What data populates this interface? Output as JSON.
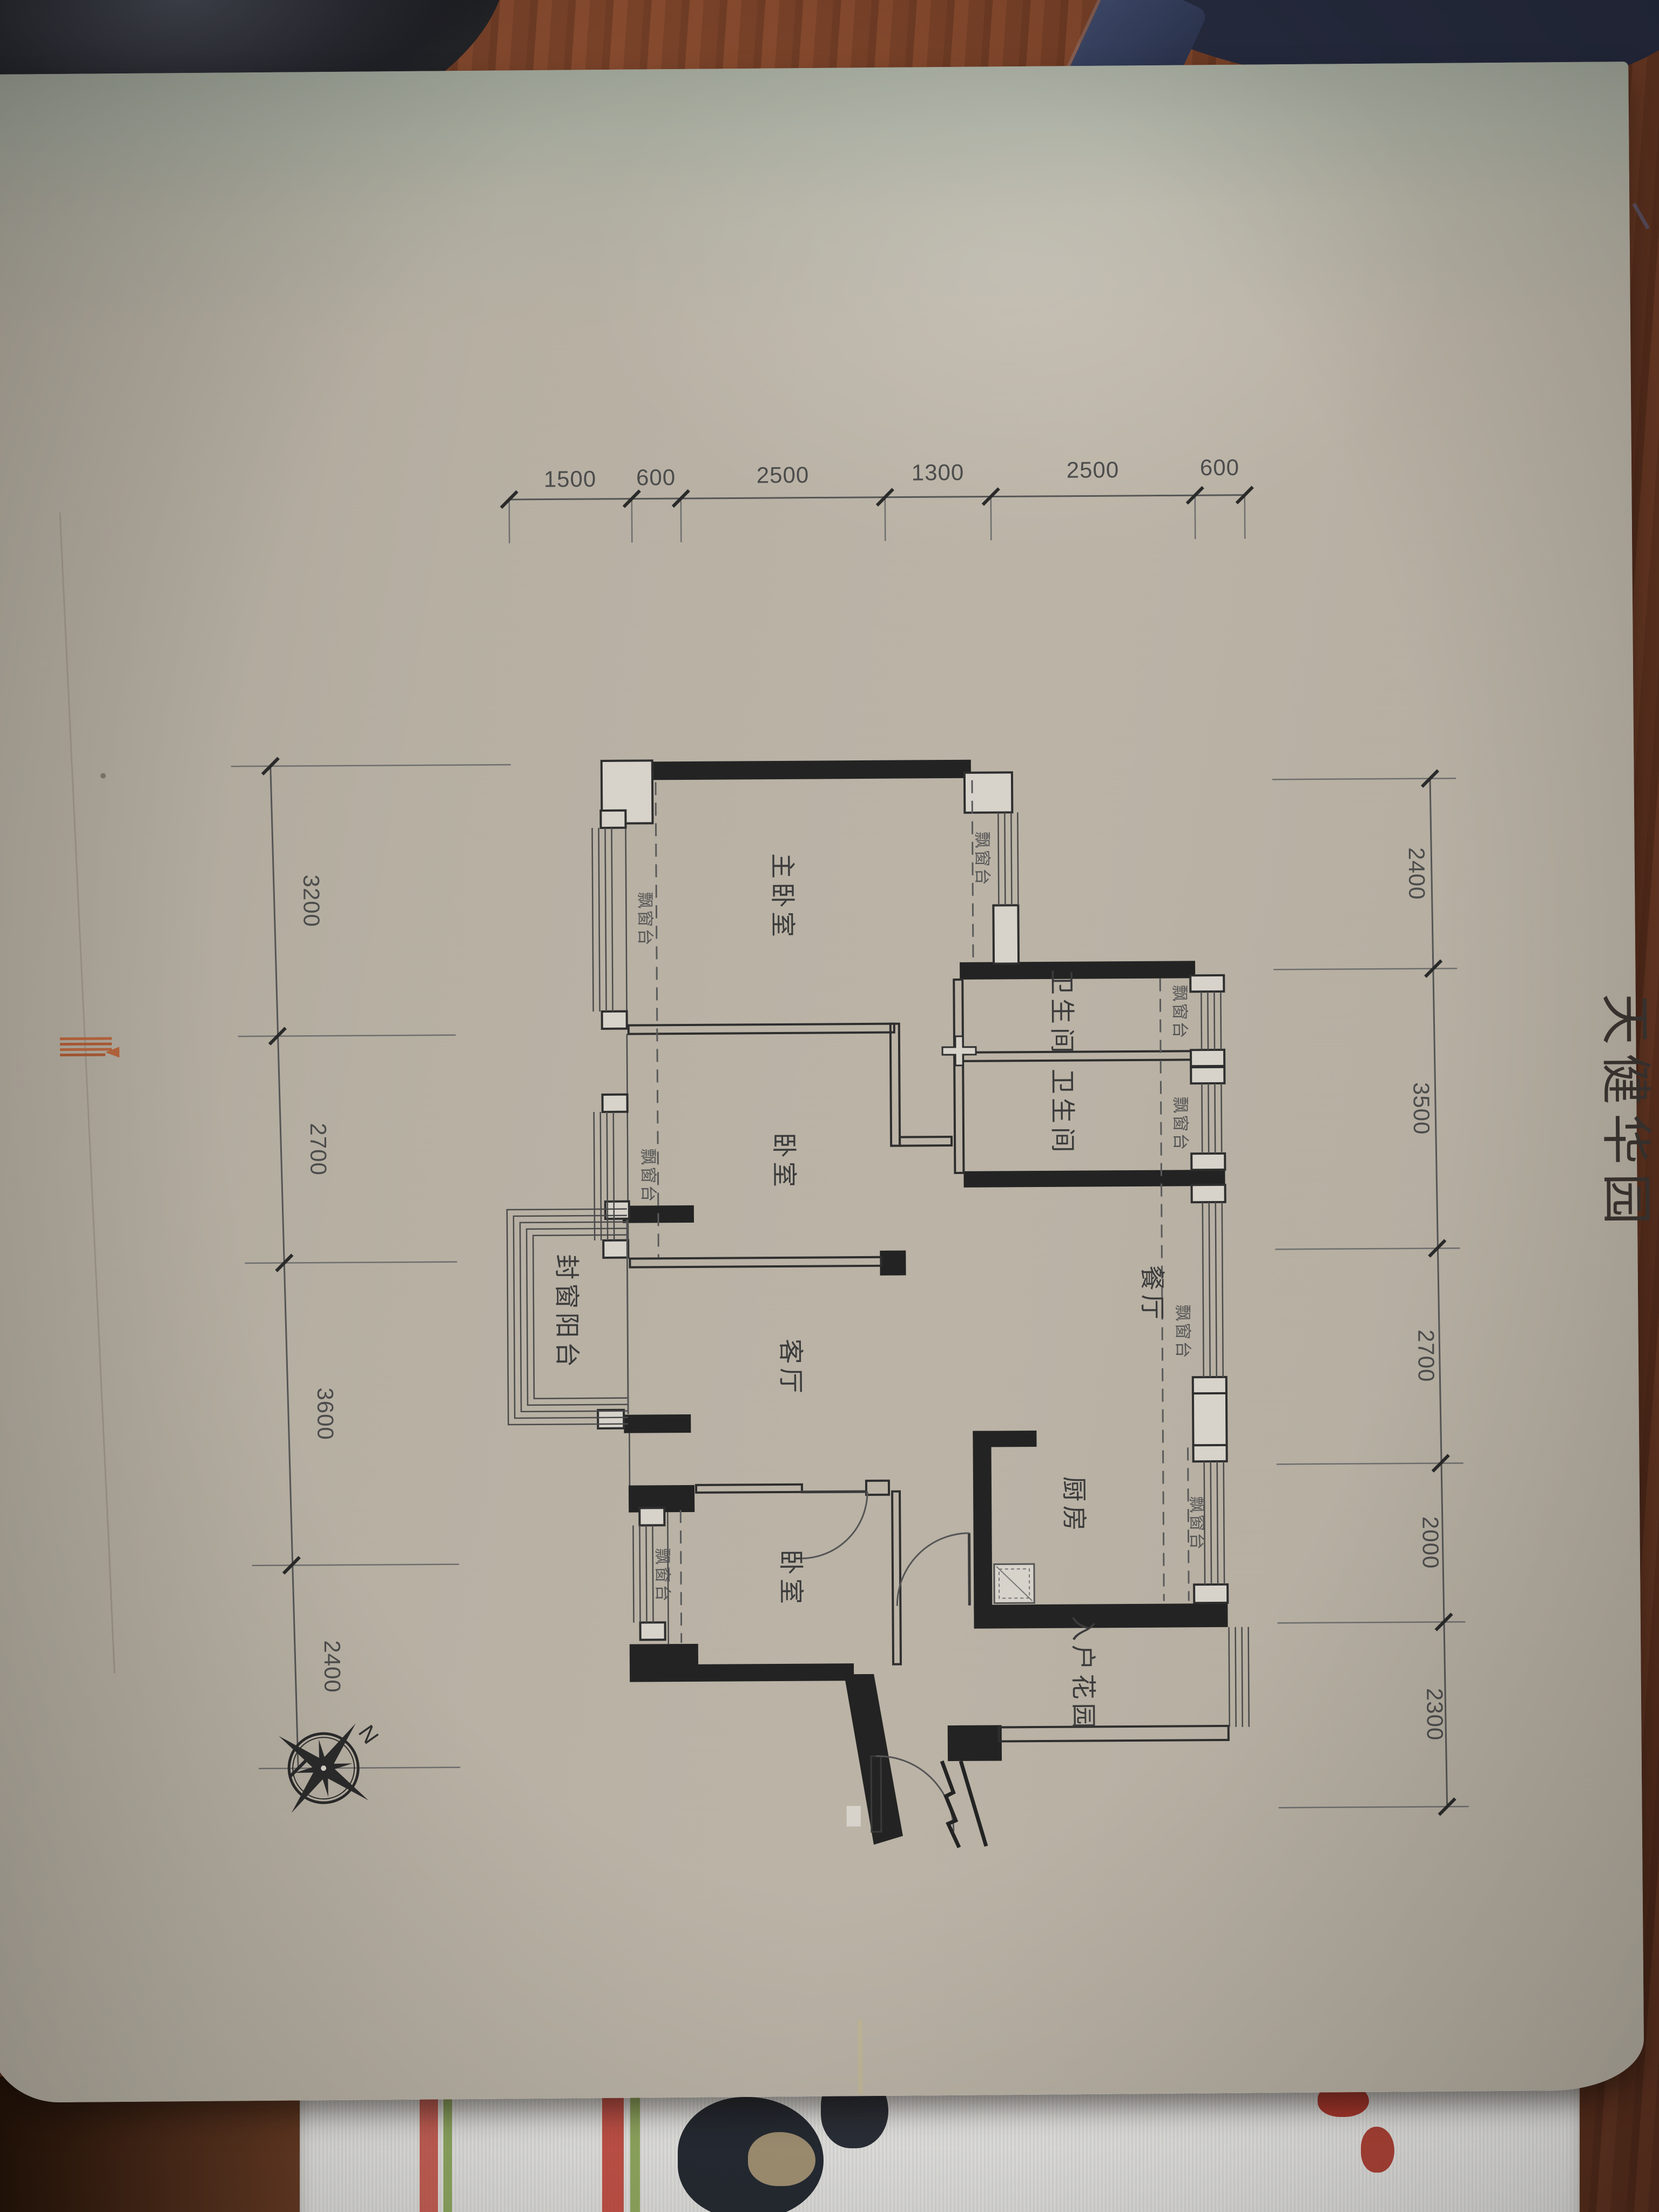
{
  "meta": {
    "title": "天健华园"
  },
  "dimensions": {
    "top": [
      "1500",
      "600",
      "2500",
      "1300",
      "2500",
      "600"
    ],
    "left": [
      "3200",
      "2700",
      "3600",
      "2400"
    ],
    "right": [
      "2400",
      "3500",
      "2700",
      "2000",
      "2300"
    ]
  },
  "rooms": {
    "master_bedroom": "主卧室",
    "bedroom": "卧室",
    "bathroom": "卫生间",
    "dining_room": "餐厅",
    "living_room": "客厅",
    "kitchen": "厨房",
    "entry_garden": "入户花园",
    "enclosed_balcony": "封窗阳台"
  },
  "labels": {
    "bay_window": "飘窗台",
    "compass_north": "N"
  },
  "colors": {
    "paper": "#d7d3cb",
    "ink": "#232323",
    "wood": "#7b4229",
    "mark_orange": "#b5643c"
  }
}
